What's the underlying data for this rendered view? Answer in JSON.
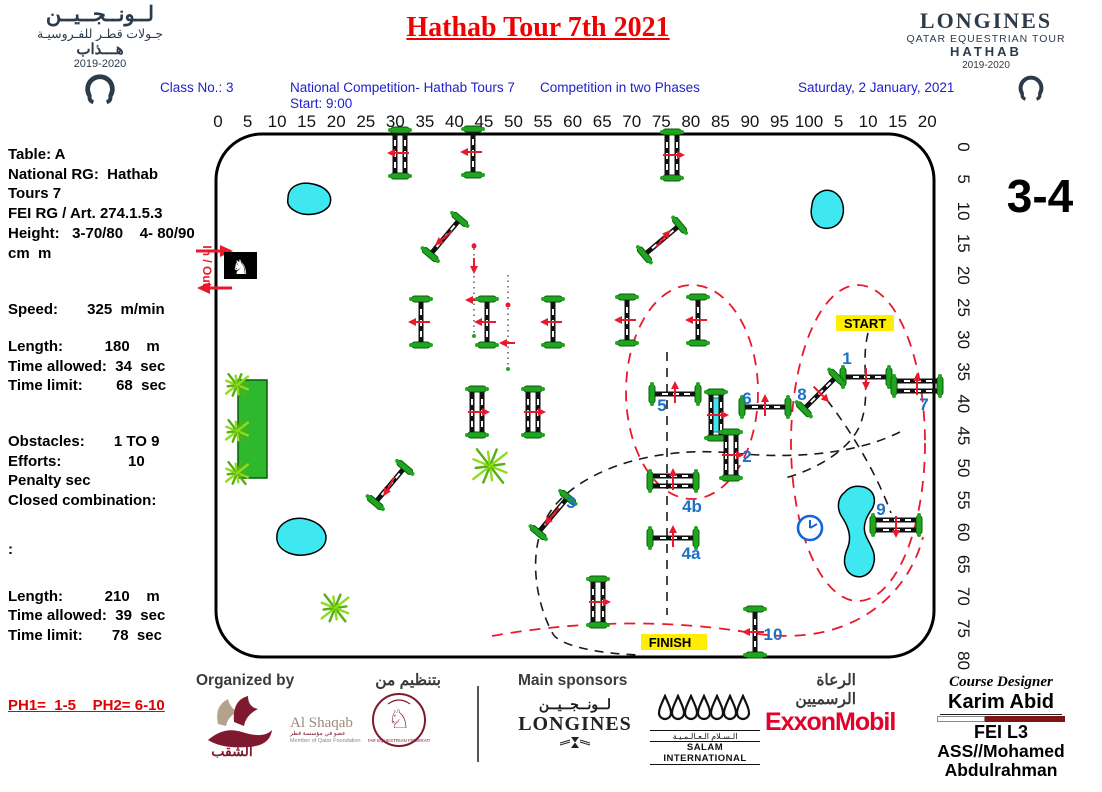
{
  "colors": {
    "title_red": "#f00000",
    "header_blue": "#2020cf",
    "number_blue": "#1e6fc8",
    "jump_green": "#1fa51f",
    "water_cyan": "#3fe8f0",
    "hedge_green": "#2eb82e",
    "maroon": "#7f1a2e",
    "navy": "#2c3b4a",
    "highlight_yellow": "#ffee00",
    "course_red": "#e8192c",
    "exxon_red": "#e4012b"
  },
  "header": {
    "title": "Hathab Tour 7th 2021",
    "class_no": "Class No.: 3",
    "competition": "National Competition- Hathab Tours 7",
    "start_time": "Start: 9:00",
    "phases": "Competition in two Phases",
    "date": "Saturday, 2 January, 2021",
    "logo_left": {
      "l1": "لــونــجــيــن",
      "l2": "جـولات قطـر للفـروسيـة",
      "l3": "هـــذاب",
      "season": "2019-2020"
    },
    "logo_right": {
      "l1": "LONGINES",
      "l2": "QATAR EQUESTRIAN TOUR",
      "l3": "HATHAB",
      "season": "2019-2020"
    }
  },
  "info_panel": {
    "lines": [
      {
        "text": "Table: A"
      },
      {
        "text": "National RG:  Hathab"
      },
      {
        "text": "Tours 7"
      },
      {
        "text": "FEI RG / Art. 274.1.5.3"
      },
      {
        "text": "Height:   3-70/80    4- 80/90"
      },
      {
        "text": "cm  m"
      },
      {
        "text": "Speed:       325  m/min",
        "gap": 37
      },
      {
        "text": "Length:          180    m",
        "gap": 17
      },
      {
        "text": "Time allowed:  34  sec"
      },
      {
        "text": "Time limit:        68  sec"
      },
      {
        "text": "Obstacles:       1 TO 9",
        "gap": 36
      },
      {
        "text": "Efforts:                10"
      },
      {
        "text": "Penalty sec"
      },
      {
        "text": "Closed combination:"
      },
      {
        "text": ":",
        "gap": 29
      },
      {
        "text": "Length:          210    m",
        "gap": 27
      },
      {
        "text": "Time allowed:  39  sec"
      },
      {
        "text": "Time limit:       78  sec"
      }
    ],
    "phase_note": "PH1=  1-5    PH2= 6-10"
  },
  "course": {
    "sheet_label": "3-4",
    "in_out": "In / Out",
    "start_label": "START",
    "finish_label": "FINISH",
    "top_ruler": [
      "0",
      "5",
      "10",
      "15",
      "20",
      "25",
      "30",
      "35",
      "40",
      "45",
      "50",
      "55",
      "60",
      "65",
      "70",
      "75",
      "80",
      "85",
      "90",
      "95",
      "100",
      "5",
      "10",
      "15",
      "20"
    ],
    "right_ruler": [
      "0",
      "5",
      "10",
      "15",
      "20",
      "25",
      "30",
      "35",
      "40",
      "45",
      "50",
      "55",
      "60",
      "65",
      "70",
      "75",
      "80"
    ],
    "obstacles": [
      {
        "x": 400,
        "y": 153,
        "rot": 90,
        "kind": "2",
        "adir": 180
      },
      {
        "x": 473,
        "y": 152,
        "rot": 90,
        "kind": "1",
        "adir": 180
      },
      {
        "x": 672,
        "y": 155,
        "rot": 90,
        "kind": "2",
        "adir": 0
      },
      {
        "x": 445,
        "y": 237,
        "rot": -50,
        "kind": "1",
        "adir": 140
      },
      {
        "x": 662,
        "y": 240,
        "rot": -40,
        "kind": "1",
        "adir": -50
      },
      {
        "x": 421,
        "y": 322,
        "rot": 90,
        "kind": "1",
        "adir": 180
      },
      {
        "x": 487,
        "y": 322,
        "rot": 90,
        "kind": "1",
        "adir": 180
      },
      {
        "x": 553,
        "y": 322,
        "rot": 90,
        "kind": "1",
        "adir": 180
      },
      {
        "x": 627,
        "y": 320,
        "rot": 90,
        "kind": "1",
        "adir": 180
      },
      {
        "x": 698,
        "y": 320,
        "rot": 90,
        "kind": "1",
        "adir": 180
      },
      {
        "x": 477,
        "y": 412,
        "rot": 90,
        "kind": "2",
        "adir": 0
      },
      {
        "x": 533,
        "y": 412,
        "rot": 90,
        "kind": "2",
        "adir": 0
      },
      {
        "x": 390,
        "y": 485,
        "rot": -50,
        "kind": "1",
        "adir": 120
      },
      {
        "x": 716,
        "y": 415,
        "rot": 90,
        "kind": "w",
        "adir": 0
      },
      {
        "x": 598,
        "y": 602,
        "rot": 90,
        "kind": "2",
        "adir": 0
      },
      {
        "label": "1",
        "x": 866,
        "y": 377,
        "rot": 0,
        "kind": "1",
        "adir": 90,
        "lx": -19,
        "ly": -13
      },
      {
        "label": "2",
        "x": 731,
        "y": 455,
        "rot": 90,
        "kind": "2",
        "adir": 0,
        "lx": 16,
        "ly": 7
      },
      {
        "label": "3",
        "x": 553,
        "y": 515,
        "rot": -50,
        "kind": "1",
        "adir": 130,
        "lx": 18,
        "ly": -7
      },
      {
        "label": "4a",
        "x": 673,
        "y": 538,
        "rot": 0,
        "kind": "1",
        "adir": -90,
        "lx": 18,
        "ly": 21
      },
      {
        "label": "4b",
        "x": 673,
        "y": 481,
        "rot": 0,
        "kind": "2",
        "adir": -90,
        "lx": 19,
        "ly": 31
      },
      {
        "label": "5",
        "x": 675,
        "y": 394,
        "rot": 0,
        "kind": "1",
        "adir": -90,
        "lx": -13,
        "ly": 17
      },
      {
        "label": "6",
        "x": 765,
        "y": 407,
        "rot": 0,
        "kind": "1",
        "adir": -90,
        "lx": -18,
        "ly": -3
      },
      {
        "label": "7",
        "x": 917,
        "y": 386,
        "rot": 0,
        "kind": "2",
        "adir": -90,
        "lx": 7,
        "ly": 24
      },
      {
        "label": "8",
        "x": 820,
        "y": 393,
        "rot": -45,
        "kind": "1",
        "adir": 45,
        "lx": -18,
        "ly": 7
      },
      {
        "label": "9",
        "x": 896,
        "y": 525,
        "rot": 0,
        "kind": "2",
        "adir": 90,
        "lx": -15,
        "ly": -10
      },
      {
        "label": "10",
        "x": 755,
        "y": 632,
        "rot": 90,
        "kind": "1",
        "adir": 180,
        "lx": 18,
        "ly": 8
      }
    ],
    "ferns": [
      {
        "x": 237,
        "y": 385,
        "s": 13
      },
      {
        "x": 237,
        "y": 431,
        "s": 13
      },
      {
        "x": 237,
        "y": 473,
        "s": 13
      },
      {
        "x": 490,
        "y": 466,
        "s": 20
      },
      {
        "x": 335,
        "y": 608,
        "s": 16
      }
    ]
  },
  "footer": {
    "organized_by": "Organized by",
    "organized_by_ar": "بتنظيم من",
    "main_sponsors": "Main sponsors",
    "sponsors_ar": "الرعاة الرسميين",
    "alshaqab_name": "Al Shaqab",
    "alshaqab_ar": "الشقب",
    "alshaqab_sub": "عضو في مؤسسة قطر",
    "alshaqab_sub2": "Member of Qatar Foundation",
    "qef_name": "QATAR EQUESTRIAN FEDERATION",
    "longines_name": "LONGINES",
    "longines_ar": "لــونــجــيــن",
    "salam_name": "SALAM INTERNATIONAL",
    "salam_ar": "الـسـلام الـعـالـمـيـة",
    "exxon": "ExxonMobil",
    "designer_heading": "Course Designer",
    "designer_name": "Karim Abid",
    "designer_level": "FEI L3",
    "designer_assistant": "ASS//Mohamed",
    "designer_assistant2": "Abdulrahman"
  }
}
